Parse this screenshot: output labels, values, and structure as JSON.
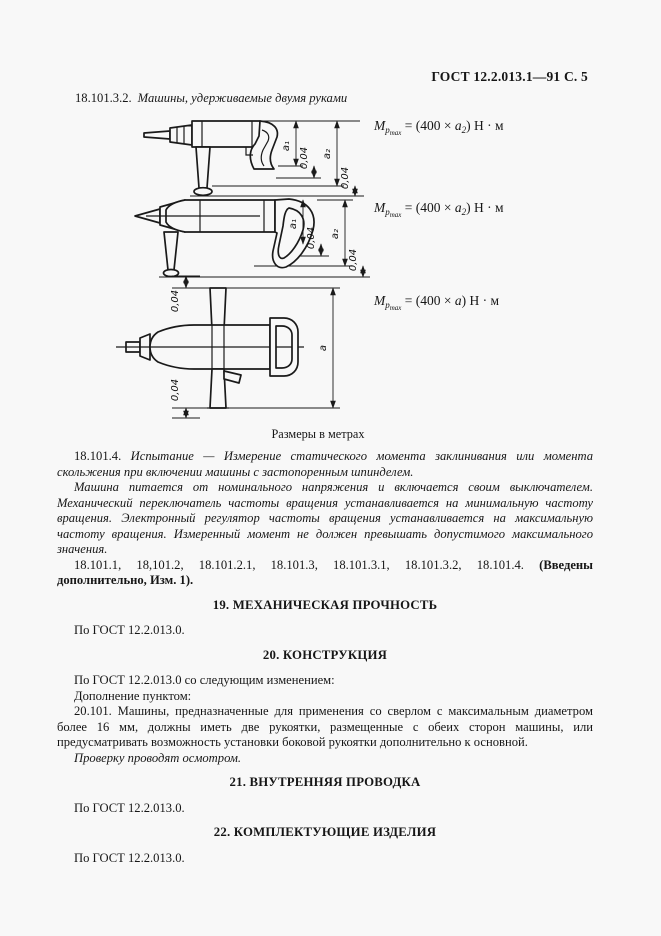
{
  "colors": {
    "page_background": "#f8f8f8",
    "ink": "#1a1a1a"
  },
  "page": {
    "header": "ГОСТ 12.2.013.1—91 С. 5"
  },
  "section18": {
    "number": "18.101.3.2.",
    "title": "Машины, удерживаемые двумя руками"
  },
  "figures": {
    "caption": "Размеры в метрах",
    "f1": {
      "labels": {
        "a1": "a₁",
        "tol1": "0,04",
        "a2": "a₂",
        "tol2": "0,04"
      }
    },
    "f2": {
      "labels": {
        "a1": "a₁",
        "tol1": "0,04",
        "a2": "a₂",
        "tol2": "0,04"
      }
    },
    "f3": {
      "labels": {
        "tol_top": "0,04",
        "tol_bottom": "0,04",
        "a": "a"
      }
    }
  },
  "formulas": {
    "f1": {
      "m": "M",
      "msub": "р",
      "msubsub": "max",
      "eq": " = (400 × ",
      "arg": "a",
      "argsub": "2",
      "rest": ") Н · м"
    },
    "f2": {
      "m": "M",
      "msub": "р",
      "msubsub": "max",
      "eq": " = (400 × ",
      "arg": "a",
      "argsub": "2",
      "rest": ") Н · м"
    },
    "f3": {
      "m": "M",
      "msub": "р",
      "msubsub": "max",
      "eq": " = (400 × ",
      "arg": "a",
      "argsub": "",
      "rest": ") Н · м"
    }
  },
  "paragraphs": {
    "p18101_4_num": "18.101.4.",
    "p18101_4_italic": "Испытание — Измерение статического момента заклинивания или момента скольжения при включении машины с застопоренным шпинделем.",
    "p_machine": "Машина питается от номинального напряжения и включается своим выключателем. Механический переключатель частоты вращения устанавливается на минимальную частоту вращения. Электронный регулятор частоты вращения устанавливается на максимальную частоту вращения. Измеренный момент не должен превышать допустимого максимального значения.",
    "p_refs": "18.101.1, 18,101.2, 18.101.2.1, 18.101.3, 18.101.3.1, 18.101.3.2, 18.101.4.",
    "p_refs_bold": "(Введены дополнительно, Изм. 1)."
  },
  "sections": [
    {
      "heading": "19. МЕХАНИЧЕСКАЯ ПРОЧНОСТЬ",
      "body": "По ГОСТ 12.2.013.0."
    },
    {
      "heading": "20. КОНСТРУКЦИЯ",
      "body": "По ГОСТ 12.2.013.0 со следующим изменением:",
      "supplement": "Дополнение пунктом:",
      "clause": "20.101. Машины, предназначенные для применения со сверлом с максимальным диаметром более 16 мм, должны иметь две рукоятки, размещенные с обеих сторон машины, или предусматривать возможность установки боковой рукоятки дополнительно к основной.",
      "check": "Проверку проводят осмотром."
    },
    {
      "heading": "21. ВНУТРЕННЯЯ ПРОВОДКА",
      "body": "По ГОСТ 12.2.013.0."
    },
    {
      "heading": "22. КОМПЛЕКТУЮЩИЕ ИЗДЕЛИЯ",
      "body": "По ГОСТ 12.2.013.0."
    }
  ]
}
